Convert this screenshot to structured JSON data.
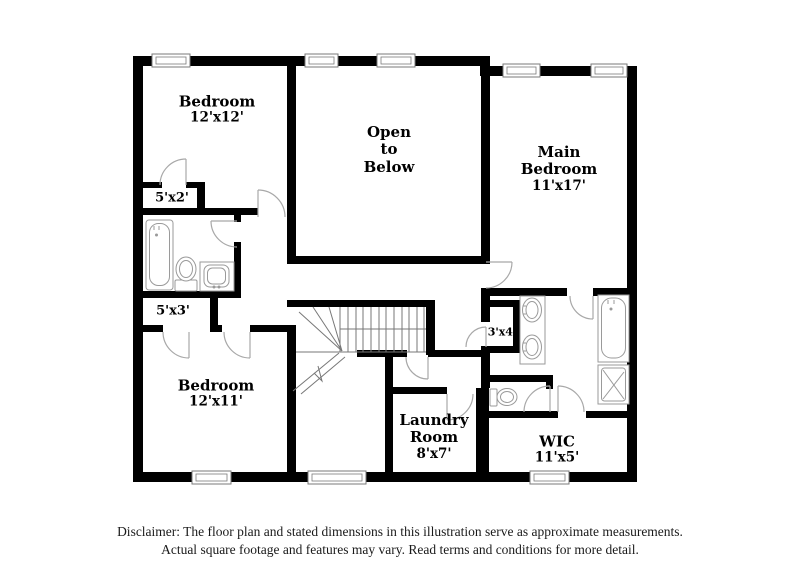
{
  "rooms": {
    "bedroom1": {
      "label": "Bedroom",
      "dims": "12'x12'"
    },
    "open_below": {
      "l1": "Open",
      "l2": "to",
      "l3": "Below"
    },
    "main_bedroom": {
      "l1": "Main",
      "l2": "Bedroom",
      "dims": "11'x17'"
    },
    "closet_5x2": {
      "dims": "5'x2'"
    },
    "closet_5x3": {
      "dims": "5'x3'"
    },
    "closet_3x4": {
      "dims": "3'x4'"
    },
    "bedroom2": {
      "label": "Bedroom",
      "dims": "12'x11'"
    },
    "laundry": {
      "l1": "Laundry",
      "l2": "Room",
      "dims": "8'x7'"
    },
    "wic": {
      "label": "WIC",
      "dims": "11'x5'"
    }
  },
  "disclaimer": {
    "line1": "Disclaimer: The floor plan and stated dimensions in this illustration serve as approximate measurements.",
    "line2": "Actual square footage and features may vary. Read terms and conditions for more detail."
  },
  "colors": {
    "wall": "#000000",
    "background": "#ffffff",
    "fixture_line": "#9a9a9a",
    "door_line": "#a8a8a8",
    "stair_line": "#777777",
    "text": "#1a1a1a"
  }
}
